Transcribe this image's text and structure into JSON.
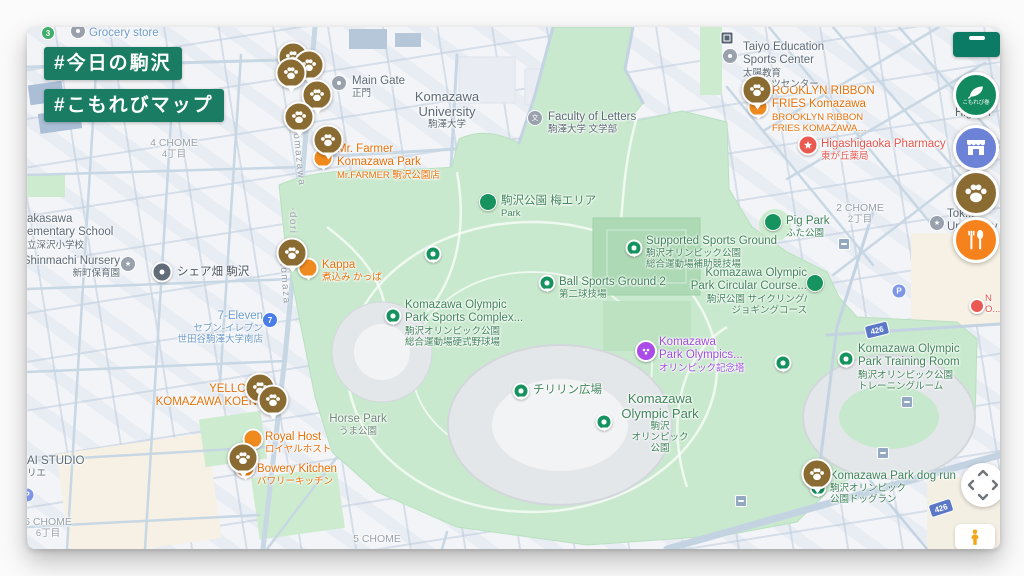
{
  "hashtags": {
    "tag1": "#今日の駒沢",
    "tag2": "#こもれびマップ"
  },
  "pois": {
    "grocery": {
      "l1": "Grocery store"
    },
    "transit3": {
      "l1": "3"
    },
    "chome4": {
      "l1": "4 CHOME",
      "l2": "4丁目"
    },
    "main_gate": {
      "l1": "Main Gate",
      "l2": "正門"
    },
    "university": {
      "l1": "Komazawa",
      "l2": "University",
      "l3": "駒澤大学"
    },
    "faculty": {
      "l1": "Faculty of Letters",
      "l2": "駒澤大学 文学部",
      "icon": "文"
    },
    "mr_farmer": {
      "l1": "Mr. Farmer",
      "l2": "Komazawa Park",
      "l3": "Mr.FARMER 駒沢公園店"
    },
    "ume_area": {
      "l1": "駒沢公園 梅エリア",
      "l2": "Park"
    },
    "ball_ground": {
      "l1": "Ball Sports Ground 2",
      "l2": "第二球技場"
    },
    "supported": {
      "l1": "Supported Sports Ground",
      "l2": "駒沢オリンピック公園",
      "l3": "総合運動場補助競技場"
    },
    "complex": {
      "l1": "Komazawa Olympic",
      "l2": "Park Sports Complex...",
      "l3": "駒沢オリンピック公園",
      "l4": "総合運動場硬式野球場"
    },
    "chirurin": {
      "l1": "チリリン広場"
    },
    "olympic_park": {
      "l1": "Komazawa",
      "l2": "Olympic Park",
      "l3": "駒沢",
      "l4": "オリンピック",
      "l5": "公園"
    },
    "memorial": {
      "l1": "Komazawa",
      "l2": "Park Olympics...",
      "l3": "オリンピック記念塔"
    },
    "circular": {
      "l1": "Komazawa Olympic",
      "l2": "Park Circular Course...",
      "l3": "駒沢公園 サイクリング/",
      "l4": "ジョギングコース"
    },
    "pig_park": {
      "l1": "Pig Park",
      "l2": "ふた公園"
    },
    "training": {
      "l1": "Komazawa Olympic",
      "l2": "Park Training Room",
      "l3": "駒沢オリンピック公園",
      "l4": "トレーニングルーム"
    },
    "dog_run": {
      "l1": "Komazawa Park dog run",
      "l2": "駒沢オリンピック",
      "l3": "公園ドッグラン"
    },
    "horse_park": {
      "l1": "Horse Park",
      "l2": "うま公園"
    },
    "brooklyn": {
      "l1": "ROOKLYN RIBBON",
      "l2": "FRIES Komazawa",
      "l3": "BROOKLYN RIBBON",
      "l4": "FRIES KOMAZAWA…"
    },
    "pharmacy": {
      "l1": "Higashigaoka Pharmacy",
      "l2": "東が丘薬局"
    },
    "taiyo": {
      "l1": "Taiyo Education",
      "l2": "Sports Center",
      "l3": "太陽教育",
      "l4": "スポーツセンター"
    },
    "chome2": {
      "l1": "2 CHOME",
      "l2": "2丁目"
    },
    "seven_eleven": {
      "l1": "7-Eleven",
      "l2": "セブン-イレブン",
      "l3": "世田谷駒澤大学南店"
    },
    "kappa": {
      "l1": "Kappa",
      "l2": "煮込み かっぱ"
    },
    "share_farm": {
      "l1": "シェア畑 駒沢"
    },
    "school": {
      "l1": "akasawa",
      "l2": "ementary School",
      "l3": "立深沢小学校"
    },
    "shinmachi": {
      "l1": "Shinmachi Nursery",
      "l2": "新町保育園"
    },
    "yellow": {
      "l1": "YELLOW",
      "l2": "KOMAZAWA KOEN"
    },
    "royal_host": {
      "l1": "Royal Host",
      "l2": "ロイヤルホスト"
    },
    "bowery": {
      "l1": "Bowery Kitchen",
      "l2": "バワリーキッチン"
    },
    "ai_studio": {
      "l1": "AI STUDIO",
      "l2": "リエ"
    },
    "chome6": {
      "l1": "6 CHOME",
      "l2": "6丁目"
    },
    "chome5": {
      "l1": "5 CHOME"
    },
    "higashi_frag": {
      "l1": "Higash"
    },
    "univ_frag": {
      "l1": "Tok...",
      "l2": "University N..."
    },
    "red_frag": {
      "l1": "N",
      "l2": "O..."
    },
    "parking": {
      "l1": "P"
    }
  },
  "streets": {
    "komazawa_dori_a": "Komazawa",
    "komazawa_dori_b": "-dori",
    "komazawa_dori_c": "Komaza",
    "route426": "426"
  },
  "controls": {
    "legend_label": "こもれび巻"
  },
  "colors": {
    "badge_green": "#1a7d63",
    "panel_teal": "#0c7b66",
    "paw_brown": "#8a6c33",
    "fab_leaf_green": "#12895e",
    "fab_shop_blue": "#6b82d6",
    "fab_food_orange": "#f6821e",
    "park_green": "#c9e9ce",
    "label_green": "#41845c",
    "label_orange": "#e8710a",
    "label_red": "#e8554d",
    "label_purple": "#a04ce0",
    "label_blue": "#6e9cc9"
  }
}
